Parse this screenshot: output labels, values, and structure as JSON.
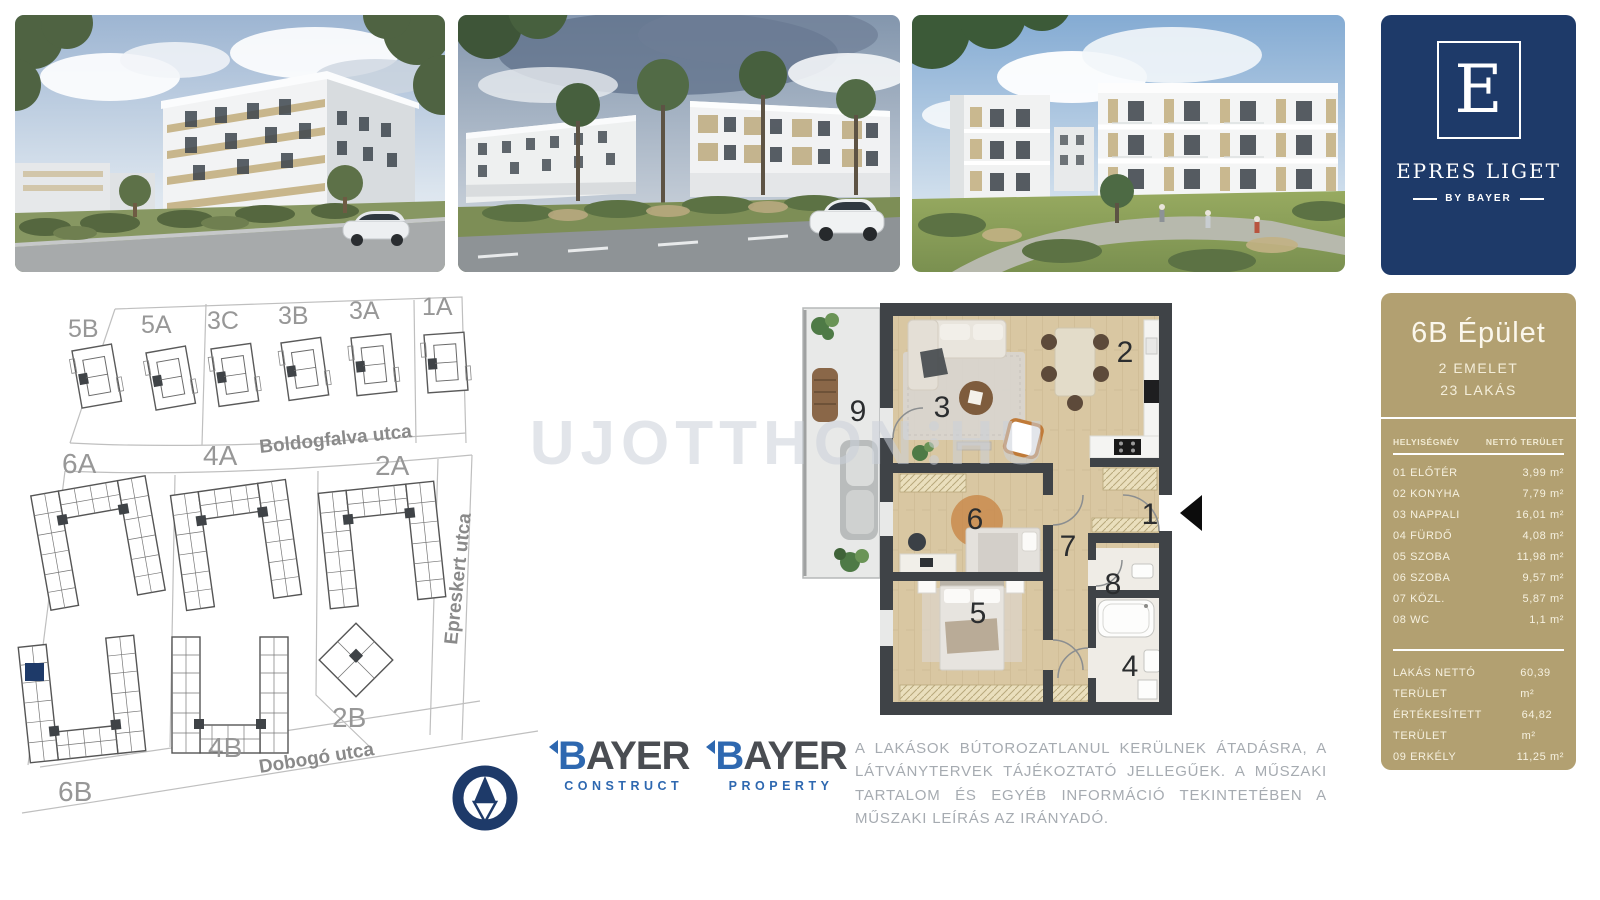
{
  "colors": {
    "navy": "#1e3a69",
    "tan": "#b2a071",
    "logo_blue": "#2e68b0",
    "logo_gray": "#4a4d52"
  },
  "brand": {
    "logo_letter": "E",
    "name": "EPRES LIGET",
    "tagline": "BY BAYER"
  },
  "site_plan": {
    "street_top": "Boldogfalva utca",
    "street_right": "Epreskert utca",
    "street_bottom": "Dobogó utca",
    "buildings_top_row": [
      "5B",
      "5A",
      "3C",
      "3B",
      "3A",
      "1A"
    ],
    "buildings_middle_row": [
      "6A",
      "4A",
      "2A"
    ],
    "buildings_bottom_row": [
      "6B",
      "4B",
      "2B"
    ],
    "highlighted_building": "6B"
  },
  "floor_plan": {
    "rooms": [
      "1",
      "2",
      "3",
      "4",
      "5",
      "6",
      "7",
      "8",
      "9"
    ],
    "watermark_left": "UJOTTHON",
    "watermark_right": "HU"
  },
  "unit_panel": {
    "title": "6B Épület",
    "floors": "2 EMELET",
    "apartments": "23 LAKÁS",
    "col_room": "HELYISÉGNÉV",
    "col_area": "NETTÓ TERÜLET",
    "rows": [
      {
        "label": "01 ELŐTÉR",
        "area": "3,99 m²"
      },
      {
        "label": "02 KONYHA",
        "area": "7,79 m²"
      },
      {
        "label": "03 NAPPALI",
        "area": "16,01 m²"
      },
      {
        "label": "04 FÜRDŐ",
        "area": "4,08 m²"
      },
      {
        "label": "05 SZOBA",
        "area": "11,98 m²"
      },
      {
        "label": "06 SZOBA",
        "area": "9,57 m²"
      },
      {
        "label": "07 KÖZL.",
        "area": "5,87 m²"
      },
      {
        "label": "08 WC",
        "area": "1,1 m²"
      }
    ],
    "totals": [
      {
        "label": "LAKÁS NETTÓ TERÜLET",
        "area": "60,39 m²"
      },
      {
        "label": "ÉRTÉKESÍTETT TERÜLET",
        "area": "64,82 m²"
      },
      {
        "label": "09 ERKÉLY",
        "area": "11,25 m²"
      }
    ]
  },
  "partner_logos": {
    "construct": {
      "name": "BAYER",
      "division": "CONSTRUCT"
    },
    "property": {
      "name": "BAYER",
      "division": "PROPERTY"
    }
  },
  "disclaimer": "A LAKÁSOK BÚTOROZATLANUL KERÜLNEK ÁTADÁSRA, A LÁTVÁNYTERVEK TÁJÉKOZTATÓ JELLEGŰEK. A MŰSZAKI TARTALOM ÉS EGYÉB INFORMÁCIÓ TEKINTETÉBEN A MŰSZAKI LEÍRÁS AZ IRÁNYADÓ."
}
